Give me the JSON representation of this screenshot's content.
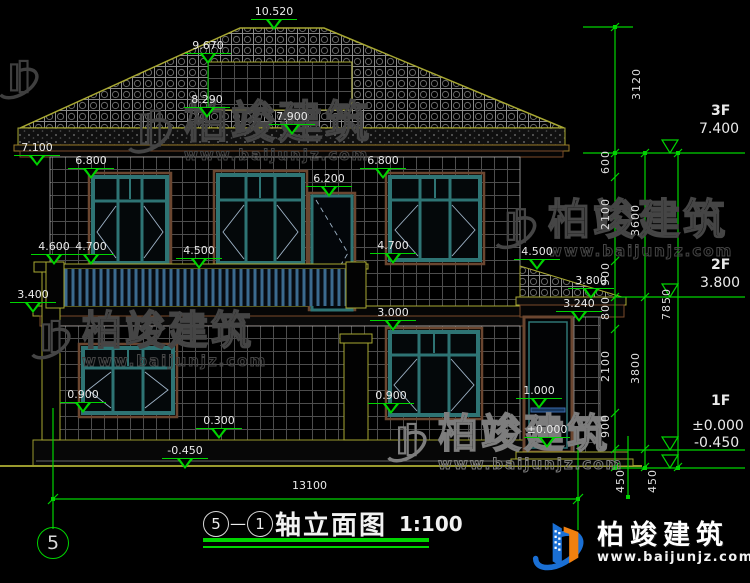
{
  "title": {
    "b1": "5",
    "dash": "—",
    "b2": "1",
    "text": "轴立面图",
    "scale": "1:100"
  },
  "axis": {
    "bubble": "5"
  },
  "brand": {
    "name": "柏竣建筑",
    "url": "www.baijunjz.com"
  },
  "elev": {
    "ridge": "10.520",
    "dormer_top": "9.670",
    "dormer_bot": "8.290",
    "roof_mid": "7.900",
    "eave": "7.100",
    "w2l": "6.800",
    "w2r": "6.800",
    "bdoor": "6.200",
    "cap": "4.600",
    "sill2l": "4.700",
    "sill2r": "4.700",
    "rail": "4.500",
    "porch_top": "4.500",
    "porch_eave": "3.800",
    "slab": "3.400",
    "beam": "3.240",
    "w1top": "3.000",
    "sill1l": "0.900",
    "sill1r": "0.900",
    "porch_rail": "1.000",
    "plinth": "0.300",
    "porch_floor": "±0.000",
    "ground": "-0.450"
  },
  "dims": {
    "s3120": "3120",
    "s600": "600",
    "s2100a": "2100",
    "s900a": "900",
    "s800": "800",
    "s2100b": "2100",
    "s900b": "900",
    "s450a": "450",
    "s3600": "3600",
    "s3800": "3800",
    "s450b": "450",
    "s7850": "7850",
    "width": "13100"
  },
  "floors": {
    "f3": "3F",
    "f3v": "7.400",
    "f2": "2F",
    "f2v": "3.800",
    "f1": "1F",
    "f1v": "±0.000",
    "f1g": "-0.450"
  },
  "colors": {
    "dim_green": "#00d400",
    "roof_olive": "#a8a832",
    "window_teal": "#2e7474",
    "trim_brown": "#6b4630",
    "rail_blue": "#3b6a8e",
    "logo_blue": "#1a6fd4",
    "logo_orange": "#f08010"
  }
}
